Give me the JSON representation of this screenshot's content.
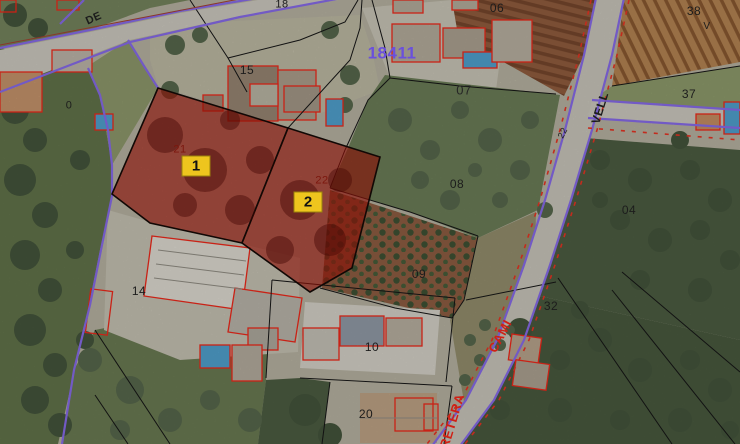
{
  "map": {
    "type": "cadastral-aerial-view",
    "cadastral_reference": "18411",
    "selected_parcels": [
      {
        "badge": "1",
        "parcel_number": "21"
      },
      {
        "badge": "2",
        "parcel_number": "22"
      }
    ],
    "colors": {
      "parcel_highlight": "#a01208",
      "parcel_badge_bg": "#eec51e",
      "boundary_black": "#151515",
      "road_edge_purple": "#8468e4",
      "building_outline_red": "#e8281a",
      "road_label_red": "#d02015",
      "reference_purple": "#6a50dc",
      "pool_blue": "#4e9cc8"
    },
    "labels": [
      {
        "text": "DE",
        "x": 94,
        "y": 19,
        "size": 11,
        "color": "#1c1c1c",
        "rot": -24,
        "bold": true
      },
      {
        "text": "18",
        "x": 282,
        "y": 5,
        "size": 11,
        "color": "#1c1c1c",
        "rot": 0,
        "bold": false
      },
      {
        "text": "18411",
        "x": 392,
        "y": 53,
        "size": 17,
        "color": "#6a50dc",
        "rot": 0,
        "bold": true
      },
      {
        "text": "06",
        "x": 497,
        "y": 8,
        "size": 12,
        "color": "#1c1c1c",
        "rot": 0,
        "bold": false
      },
      {
        "text": "38",
        "x": 694,
        "y": 11,
        "size": 12,
        "color": "#1c1c1c",
        "rot": 0,
        "bold": false
      },
      {
        "text": "V",
        "x": 707,
        "y": 27,
        "size": 10,
        "color": "#1c1c1c",
        "rot": 0,
        "bold": false
      },
      {
        "text": "15",
        "x": 247,
        "y": 70,
        "size": 12,
        "color": "#1c1c1c",
        "rot": 0,
        "bold": false
      },
      {
        "text": "07",
        "x": 464,
        "y": 90,
        "size": 13,
        "color": "#262626",
        "rot": 0,
        "bold": false
      },
      {
        "text": "37",
        "x": 689,
        "y": 94,
        "size": 12,
        "color": "#1c1c1c",
        "rot": 0,
        "bold": false
      },
      {
        "text": "VELL",
        "x": 600,
        "y": 108,
        "size": 12,
        "color": "#1c1c1c",
        "rot": -73,
        "bold": true
      },
      {
        "text": "22",
        "x": 563,
        "y": 133,
        "size": 9,
        "color": "#1c1c1c",
        "rot": -63,
        "bold": false
      },
      {
        "text": "21",
        "x": 180,
        "y": 150,
        "size": 11,
        "color": "#7c170d",
        "rot": 0,
        "bold": false
      },
      {
        "text": "22",
        "x": 322,
        "y": 181,
        "size": 11,
        "color": "#7c170d",
        "rot": 0,
        "bold": false
      },
      {
        "text": "08",
        "x": 457,
        "y": 184,
        "size": 12,
        "color": "#1c1c1c",
        "rot": 0,
        "bold": false
      },
      {
        "text": "04",
        "x": 629,
        "y": 210,
        "size": 12,
        "color": "#1c1c1c",
        "rot": 0,
        "bold": false
      },
      {
        "text": "09",
        "x": 419,
        "y": 274,
        "size": 12,
        "color": "#1c1c1c",
        "rot": 0,
        "bold": false
      },
      {
        "text": "32",
        "x": 551,
        "y": 306,
        "size": 12,
        "color": "#1c1c1c",
        "rot": 0,
        "bold": false
      },
      {
        "text": "CAMI",
        "x": 500,
        "y": 336,
        "size": 13,
        "color": "#d02015",
        "rot": -62,
        "bold": true
      },
      {
        "text": "10",
        "x": 372,
        "y": 347,
        "size": 12,
        "color": "#1c1c1c",
        "rot": 0,
        "bold": false
      },
      {
        "text": "14",
        "x": 139,
        "y": 291,
        "size": 12,
        "color": "#1c1c1c",
        "rot": 0,
        "bold": false
      },
      {
        "text": "20",
        "x": 366,
        "y": 414,
        "size": 12,
        "color": "#1c1c1c",
        "rot": 0,
        "bold": false
      },
      {
        "text": "RETERA",
        "x": 452,
        "y": 421,
        "size": 13,
        "color": "#d02015",
        "rot": -73,
        "bold": true
      },
      {
        "text": "0",
        "x": 69,
        "y": 106,
        "size": 11,
        "color": "#1c1c1c",
        "rot": 0,
        "bold": false
      }
    ],
    "badges": [
      {
        "label": "1",
        "x": 196,
        "y": 166
      },
      {
        "label": "2",
        "x": 308,
        "y": 202
      }
    ]
  }
}
